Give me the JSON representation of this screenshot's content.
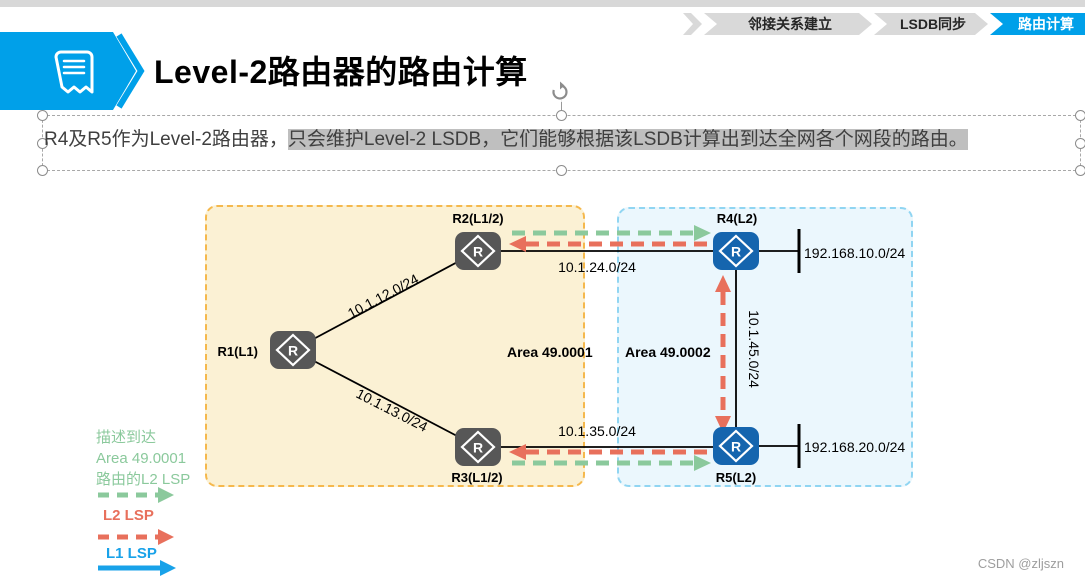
{
  "slide": {
    "title": "Level-2路由器的路由计算",
    "body": {
      "normal": "R4及R5作为Level-2路由器，",
      "highlighted": "只会维护Level-2 LSDB，它们能够根据该LSDB计算出到达全网各个网段的路由。"
    },
    "watermark": "CSDN @zljszn"
  },
  "steps": [
    {
      "label": "邻接关系建立",
      "active": false
    },
    {
      "label": "LSDB同步",
      "active": false
    },
    {
      "label": "路由计算",
      "active": true
    }
  ],
  "diagram": {
    "router_letter": "R",
    "areas": [
      {
        "name": "Area 49.0001"
      },
      {
        "name": "Area 49.0002"
      }
    ],
    "routers": [
      {
        "id": "R1",
        "label": "R1(L1)"
      },
      {
        "id": "R2",
        "label": "R2(L1/2)"
      },
      {
        "id": "R3",
        "label": "R3(L1/2)"
      },
      {
        "id": "R4",
        "label": "R4(L2)"
      },
      {
        "id": "R5",
        "label": "R5(L2)"
      }
    ],
    "links": [
      {
        "between": "R1-R2",
        "label": "10.1.12.0/24"
      },
      {
        "between": "R1-R3",
        "label": "10.1.13.0/24"
      },
      {
        "between": "R2-R4",
        "label": "10.1.24.0/24"
      },
      {
        "between": "R3-R5",
        "label": "10.1.35.0/24"
      },
      {
        "between": "R4-R5",
        "label": "10.1.45.0/24"
      }
    ],
    "stub_networks": [
      {
        "router": "R4",
        "label": "192.168.10.0/24"
      },
      {
        "router": "R5",
        "label": "192.168.20.0/24"
      }
    ]
  },
  "legend": {
    "green_line1": "描述到达",
    "green_line2": "Area 49.0001",
    "green_line3": "路由的L2 LSP",
    "red_label": "L2 LSP",
    "blue_label": "L1 LSP"
  },
  "icons": {
    "banner": "bookmark-note-icon",
    "rotate": "rotate-handle-icon",
    "router": "router-diamond-icon"
  },
  "colors": {
    "accent_blue": "#00A0E9",
    "router_blue": "#1565AE",
    "router_gray": "#575757",
    "area1_fill": "#FBF1D4",
    "area1_border": "#F5B84C",
    "area2_fill": "#EBF7FD",
    "area2_border": "#90D5F2",
    "lsp_green": "#8BC99C",
    "lsp_red": "#E8705C",
    "lsp_blue": "#18A2E9",
    "highlight_gray": "#BFBFBF",
    "step_gray": "#D9D9D9"
  }
}
